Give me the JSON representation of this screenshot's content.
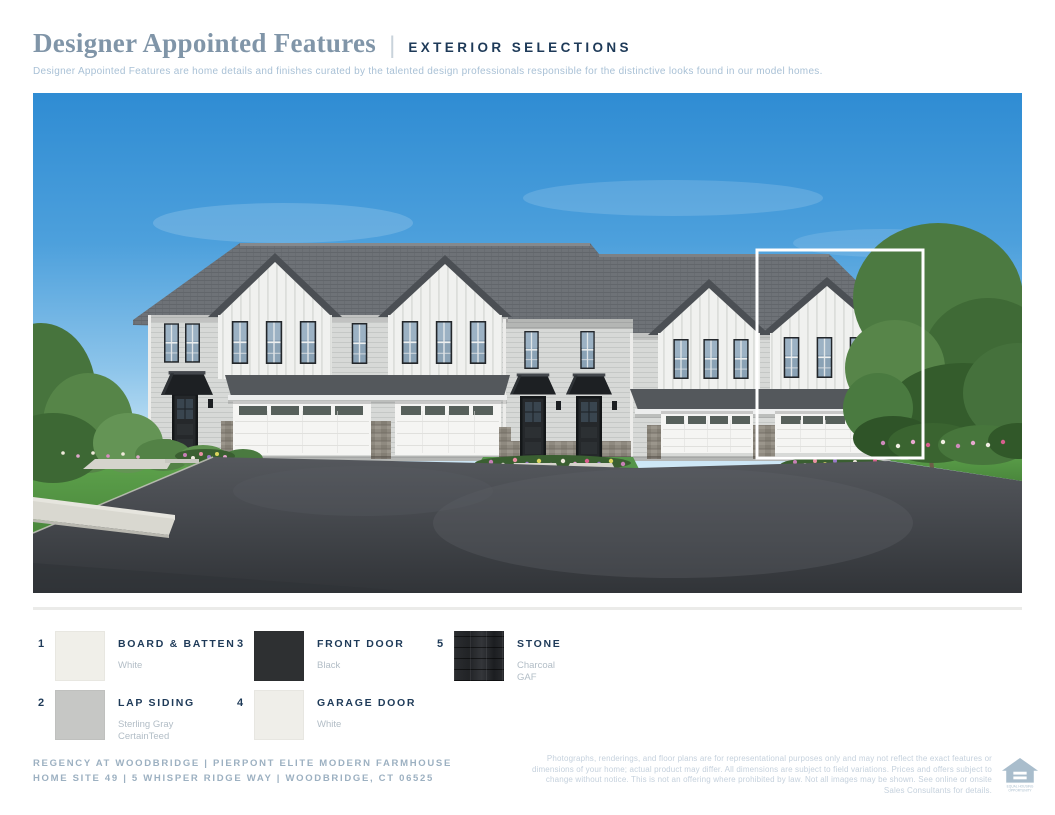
{
  "page": {
    "background": "#ffffff"
  },
  "header": {
    "title": "Designer Appointed Features",
    "separator": "|",
    "section_label": "EXTERIOR SELECTIONS",
    "description": "Designer Appointed Features are home details and finishes curated by the talented design professionals responsible for the distinctive looks found in our model homes.",
    "title_color": "#8095a8",
    "section_label_color": "#1e3a58",
    "description_color": "#a9c1d6"
  },
  "rendering": {
    "caption": "Exterior rendering of modern farmhouse townhomes with highlighted end unit",
    "highlight_box_color": "#ffffff",
    "sky_top_color": "#2f8cd3",
    "roof_color": "#6e7277",
    "lap_siding_color": "#d7d9d7",
    "board_batten_color": "#f0f1ef",
    "front_door_color": "#25282b",
    "garage_door_color": "#f5f5f3",
    "stone_color": "#8f8a80",
    "grass_color": "#55a047",
    "asphalt_color": "#45484d"
  },
  "legend": {
    "accent_color": "#1e3a58",
    "detail_color": "#b2bdc6",
    "items": [
      {
        "number": "1",
        "label": "BOARD & BATTEN",
        "detail": "White",
        "detail2": "",
        "swatch_color": "#f0efe9"
      },
      {
        "number": "2",
        "label": "LAP SIDING",
        "detail": "Sterling Gray",
        "detail2": "CertainTeed",
        "swatch_color": "#c6c7c5"
      },
      {
        "number": "3",
        "label": "FRONT DOOR",
        "detail": "Black",
        "detail2": "",
        "swatch_color": "#2e3032"
      },
      {
        "number": "4",
        "label": "GARAGE DOOR",
        "detail": "White",
        "detail2": "",
        "swatch_color": "#efeee9"
      },
      {
        "number": "5",
        "label": "STONE",
        "detail": "Charcoal",
        "detail2": "GAF",
        "swatch_color": "#26282b"
      }
    ]
  },
  "footer": {
    "community_line": "REGENCY AT WOODBRIDGE | PIERPONT ELITE MODERN FARMHOUSE",
    "address_line": "HOME SITE 49 | 5 WHISPER RIDGE WAY | WOODBRIDGE, CT 06525",
    "disclaimer": "Photographs, renderings, and floor plans are for representational purposes only and may not reflect the exact features or dimensions of your home; actual product may differ. All dimensions are subject to field variations. Prices and offers subject to change without notice. This is not an offering where prohibited by law. Not all images may be shown. See online or onsite Sales Consultants for details.",
    "text_color": "#9cb0c1",
    "disclaimer_color": "#c5d1dd",
    "equal_housing_logo": {
      "line1": "EQUAL HOUSING",
      "line2": "OPPORTUNITY",
      "color": "#a9bdcc"
    }
  }
}
